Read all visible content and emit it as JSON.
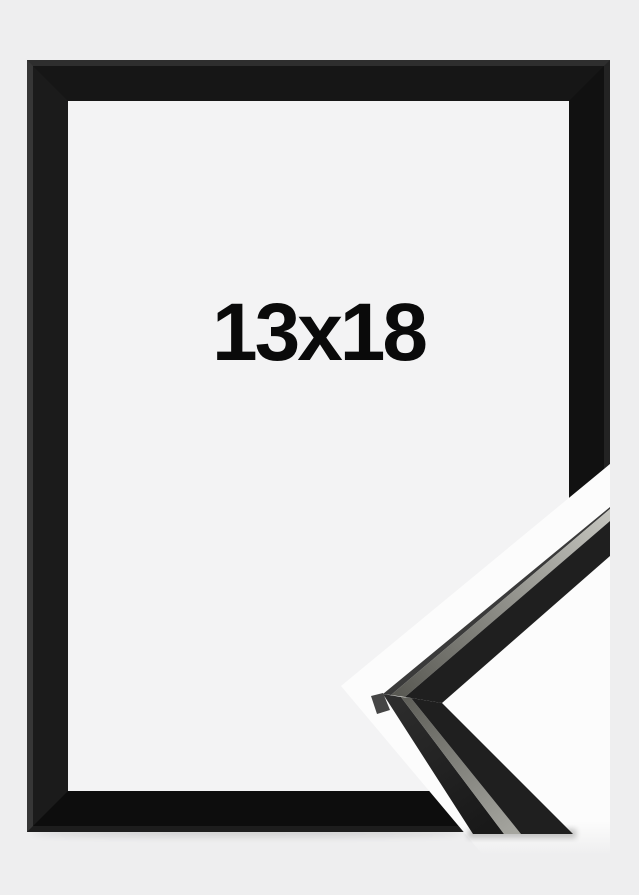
{
  "product": {
    "size_label": "13x18"
  },
  "colors": {
    "background": "#eeeeef",
    "interior": "#f3f3f4",
    "overlay_white": "#fcfcfc",
    "frame_black": "#141414",
    "piece_black": "#1f1f1f",
    "piece_side_black": "#232323",
    "accent_silver": "#9a9a94",
    "label_text": "#0a0a0a"
  }
}
